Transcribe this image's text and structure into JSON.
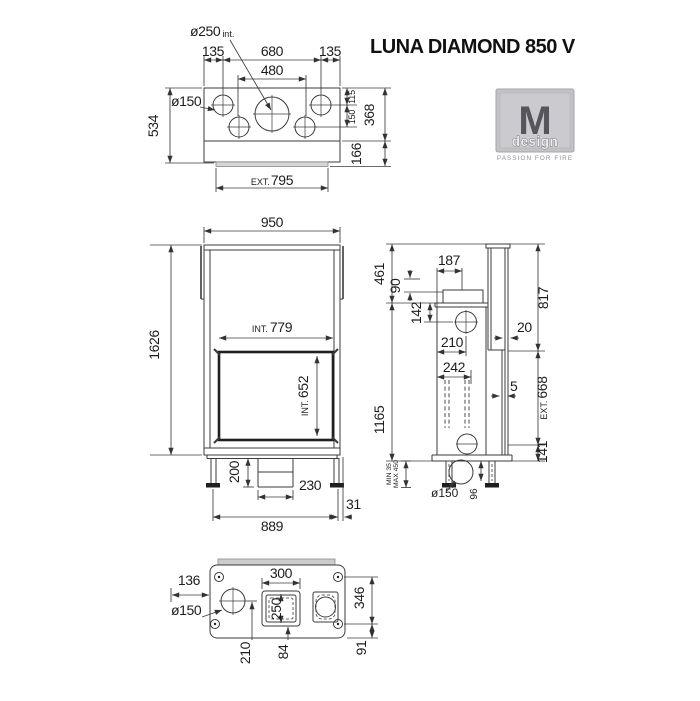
{
  "title": "LUNA DIAMOND 850 V",
  "logo": {
    "letter": "M",
    "name": "design",
    "tagline": "PASSION FOR FIRE"
  },
  "colors": {
    "line": "#3b3b3b",
    "text": "#1d1d1d",
    "logo_bg": "#c2c2c6",
    "logo_dark": "#55555b"
  },
  "top_view": {
    "flue": "ø250",
    "flue_note": "int.",
    "dim_135_left": "135",
    "dim_680": "680",
    "dim_135_right": "135",
    "dim_480": "480",
    "vent": "ø150",
    "dim_534": "534",
    "dim_115": "115",
    "dim_150": "150",
    "dim_368": "368",
    "dim_166": "166",
    "ext_prefix": "EXT.",
    "dim_795": "795"
  },
  "front_view": {
    "dim_950": "950",
    "dim_1626": "1626",
    "int_prefix": "INT.",
    "dim_779": "779",
    "dim_652": "652",
    "dim_200": "200",
    "dim_230": "230",
    "dim_31": "31",
    "dim_889": "889"
  },
  "side_view": {
    "dim_461": "461",
    "dim_187": "187",
    "dim_90": "90",
    "dim_142": "142",
    "dim_210": "210",
    "dim_242": "242",
    "dim_20": "20",
    "dim_5": "5",
    "dim_817": "817",
    "dim_1165": "1165",
    "ext_prefix": "EXT.",
    "dim_668": "668",
    "dim_141": "141",
    "min_adjust": "MIN 35",
    "max_adjust": "MAX 450",
    "outlet": "ø150",
    "dim_96": "96"
  },
  "bottom_view": {
    "dim_136": "136",
    "vent": "ø150",
    "dim_300": "300",
    "dim_250": "250",
    "dim_346": "346",
    "dim_210": "210",
    "dim_84": "84",
    "dim_91": "91"
  }
}
